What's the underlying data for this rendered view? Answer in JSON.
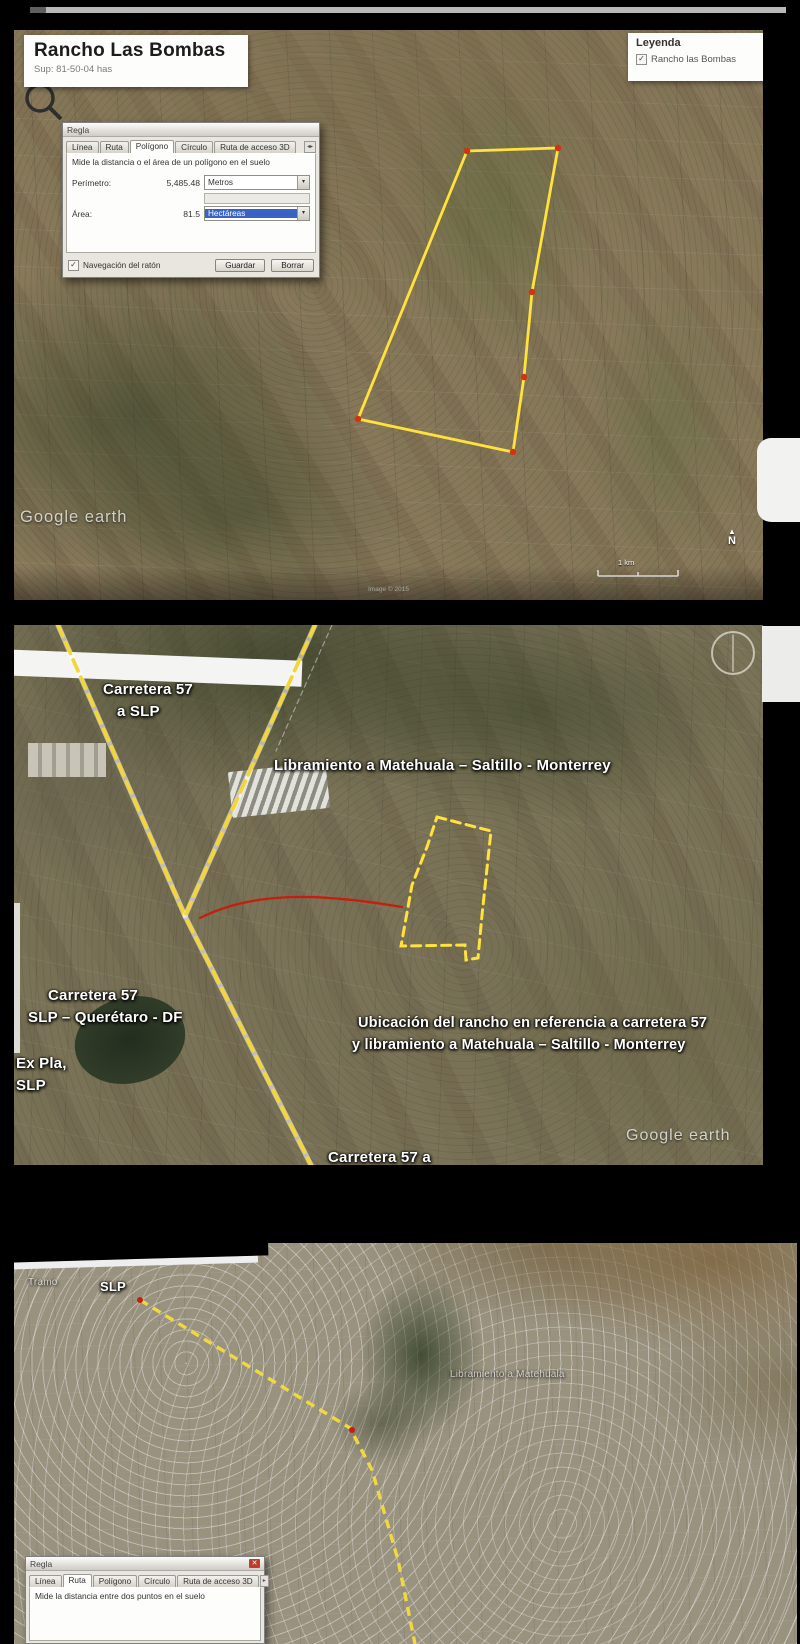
{
  "colors": {
    "route_yellow": "#f2d63b",
    "polygon_yellow": "#ffe23c",
    "marker_red": "#c41f0e",
    "map_label_white": "#ffffff"
  },
  "map1": {
    "title": "Rancho Las Bombas",
    "subtitle": "Sup: 81-50-04 has",
    "legend": {
      "title": "Leyenda",
      "item": "Rancho las Bombas"
    },
    "dialog": {
      "title": "Regla",
      "tabs": [
        "Línea",
        "Ruta",
        "Polígono",
        "Círculo",
        "Ruta de acceso 3D"
      ],
      "description": "Mide la distancia o el área de un polígono en el suelo",
      "perimeter_label": "Perímetro:",
      "perimeter_value": "5,485.48",
      "perimeter_unit": "Metros",
      "area_label": "Área:",
      "area_value": "81.5",
      "area_unit": "Hectáreas",
      "nav_checkbox": "Navegación del ratón",
      "save": "Guardar",
      "clear": "Borrar"
    },
    "watermark": "Google earth",
    "attribution": "Image © 2015",
    "scale_label": "1 km",
    "compass_letter": "N"
  },
  "map2": {
    "labels": {
      "hwy57_north_1": "Carretera 57",
      "hwy57_north_2": "a SLP",
      "libramiento": "Libramiento a Matehuala – Saltillo - Monterrey",
      "hwy57_mid_1": "Carretera 57",
      "hwy57_mid_2": "SLP – Querétaro - DF",
      "ex_pla_1": "Ex Pla,",
      "ex_pla_2": "SLP",
      "ubicacion_1": "Ubicación del rancho en referencia a carretera 57",
      "ubicacion_2": "y libramiento a Matehuala – Saltillo - Monterrey",
      "hwy57_south_1": "Carretera 57 a",
      "hwy57_south_2": "Querétaro"
    },
    "watermark": "Google earth"
  },
  "map3": {
    "labels": {
      "slp": "SLP",
      "faint_town": "Tramo",
      "faint_road": "Libramiento a Matehuala"
    },
    "dialog": {
      "title": "Regla",
      "tabs": [
        "Línea",
        "Ruta",
        "Polígono",
        "Círculo",
        "Ruta de acceso 3D"
      ],
      "description": "Mide la distancia entre dos puntos en el suelo"
    }
  }
}
